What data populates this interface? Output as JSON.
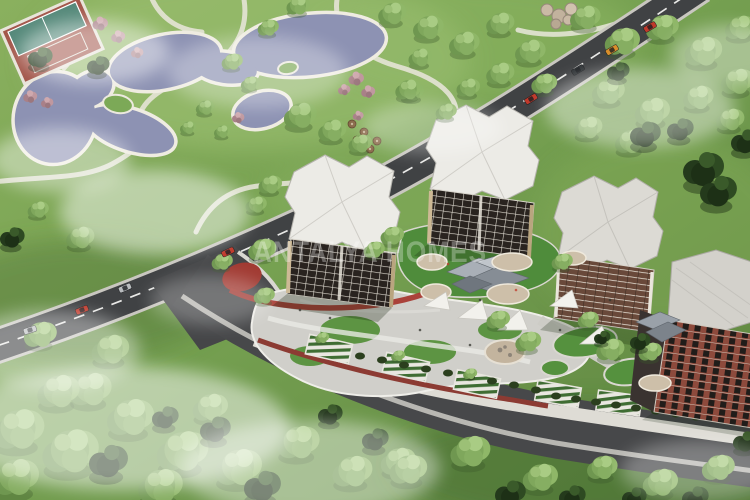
{
  "scene": {
    "type": "aerial architectural rendering",
    "description": "Bird's-eye 3D visualization of a residential complex: four apartment towers around landscaped courtyards with angular shade canopies, sail shades, playgrounds and striped parking bays; a public park with a winding ornamental lake and a sports court; tree-lined roads with cars and drifting mist",
    "watermark": {
      "text": "ANTALYA HOMES"
    },
    "palette": {
      "grass": "#76a151",
      "grass_light": "#a4c677",
      "grass_dark": "#4e7336",
      "water": "#8d92b3",
      "shoreline": "#efece1",
      "path": "#eae7dd",
      "asphalt": "#404244",
      "asphalt_wide": "#47484a",
      "road_marking": "#e9e9e7",
      "sidewalk": "#dedcd5",
      "roof_white": "#ecebe6",
      "roof_gray": "#d6d4ce",
      "facade_dark": "#29231f",
      "facade_brown": "#69493a",
      "facade_brick": "#8d4a3c",
      "window_trim": "#ded9cf",
      "canopy_gray": "#959ba3",
      "shade_sail": "#f2f1ec",
      "track_red": "#a83a31",
      "court_turf": "#55897a",
      "court_clay": "#a3574b",
      "parking_stripe_green": "#3f6d33",
      "tree_light": "#86ae62",
      "tree_dark": "#2a4020",
      "tree_blossom": "#b58d95",
      "rock_beige": "#c9b9a6",
      "car_red": "#c0392b",
      "car_orange": "#d98e2b",
      "car_silver": "#b9bcbe",
      "car_dark": "#2f3336",
      "mist": "#ffffff"
    }
  }
}
